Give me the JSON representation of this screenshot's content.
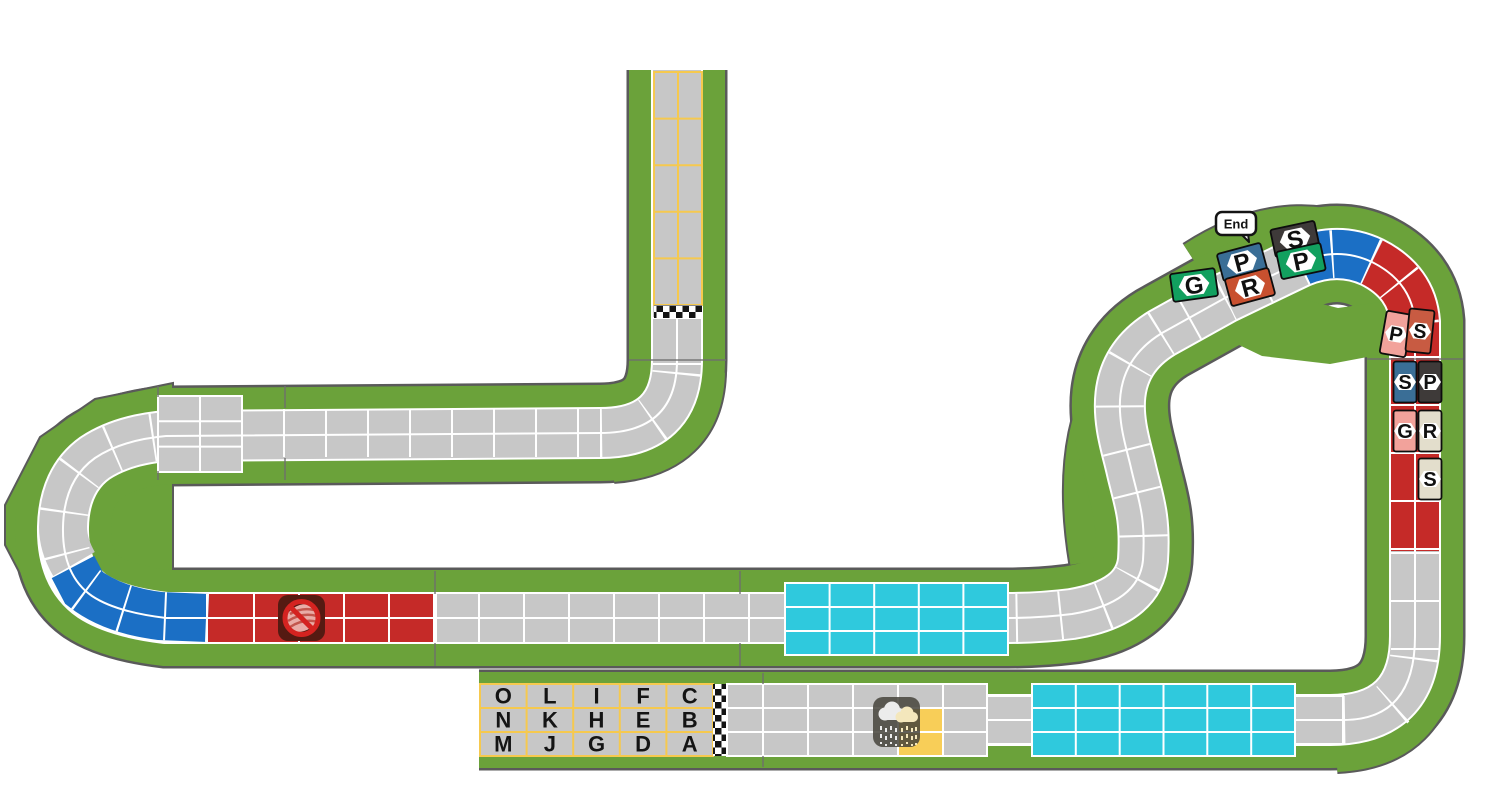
{
  "labels": {
    "end": "End"
  },
  "start_grid": {
    "rows": [
      [
        "O",
        "L",
        "I",
        "F",
        "C"
      ],
      [
        "N",
        "K",
        "H",
        "E",
        "B"
      ],
      [
        "M",
        "J",
        "G",
        "D",
        "A"
      ]
    ]
  },
  "riders": [
    {
      "id": "rider-green-G",
      "letter": "G",
      "color": "#12A05F",
      "x": 1194,
      "y": 285,
      "w": 45,
      "h": 28,
      "rot": -8
    },
    {
      "id": "rider-blue-P",
      "letter": "P",
      "color": "#3A6E96",
      "x": 1242,
      "y": 262,
      "w": 45,
      "h": 28,
      "rot": -15
    },
    {
      "id": "rider-red-R",
      "letter": "R",
      "color": "#C8502F",
      "x": 1250,
      "y": 287,
      "w": 45,
      "h": 28,
      "rot": -15
    },
    {
      "id": "rider-black-S",
      "letter": "S",
      "color": "#3E3A39",
      "x": 1295,
      "y": 239,
      "w": 45,
      "h": 28,
      "rot": -12
    },
    {
      "id": "rider-green-P",
      "letter": "P",
      "color": "#12A05F",
      "x": 1301,
      "y": 261,
      "w": 45,
      "h": 28,
      "rot": -12
    },
    {
      "id": "rider-pink-P",
      "letter": "P",
      "color": "#F2A29B",
      "x": 1396,
      "y": 334,
      "w": 26,
      "h": 43,
      "rot": 10
    },
    {
      "id": "rider-salmon-S",
      "letter": "S",
      "color": "#C85B42",
      "x": 1420,
      "y": 331,
      "w": 25,
      "h": 43,
      "rot": 6
    },
    {
      "id": "rider-blue-S",
      "letter": "S",
      "color": "#3A6E96",
      "x": 1405,
      "y": 382,
      "w": 23,
      "h": 41,
      "rot": 0
    },
    {
      "id": "rider-black-P",
      "letter": "P",
      "color": "#3E3A39",
      "x": 1430,
      "y": 382,
      "w": 23,
      "h": 41,
      "rot": 0
    },
    {
      "id": "rider-pink-G",
      "letter": "G",
      "color": "#F2A29B",
      "x": 1405,
      "y": 431,
      "w": 23,
      "h": 41,
      "rot": 0
    },
    {
      "id": "rider-beige-R",
      "letter": "R",
      "color": "#E3DECC",
      "x": 1430,
      "y": 431,
      "w": 23,
      "h": 41,
      "rot": 0
    },
    {
      "id": "rider-beige-S",
      "letter": "S",
      "color": "#E3DECC",
      "x": 1430,
      "y": 479,
      "w": 23,
      "h": 41,
      "rot": 0
    }
  ],
  "icons": {
    "no_slipstream": {
      "name": "no-slipstream-icon"
    },
    "weather_rain": {
      "name": "rain-cloud-icon"
    }
  },
  "colors": {
    "grass": "#6BA23A",
    "road": "#C7C7C7",
    "outline": "#5A5A5A",
    "climb_red": "#C52A28",
    "descent_blue": "#1B6FC5",
    "supply_cyan": "#2FC9DD",
    "special_yellow": "#F8CE58",
    "grid_line_yellow": "#F6C94E"
  }
}
